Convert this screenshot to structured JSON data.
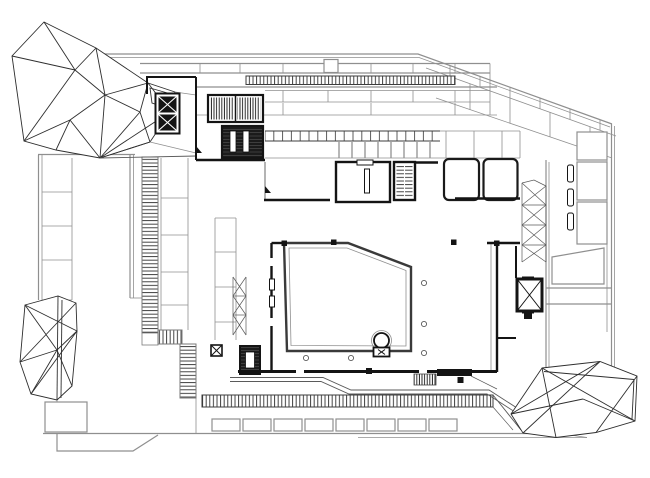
{
  "figure": {
    "kind": "architectural-floor-plan",
    "aria_label": "Black and white architectural floor plan drawing of a museum level with three faceted crystalline volumes, stair and elevator cores, hatched stair strips, colonnade bands and gallery walls"
  },
  "colors": {
    "bg": "#ffffff",
    "env": "#8f8f8f",
    "black": "#141414",
    "dgray": "#3a3a3a",
    "hatch": "#2f2f2f",
    "thin": "#5a5a5a",
    "crystal": "#2e2e2e"
  },
  "elements": {
    "top_left_crystal": "faceted crystal volume",
    "bottom_left_crystal": "faceted crystal volume",
    "bottom_right_crystal": "faceted crystal volume",
    "stair_cores": "hatched stair and service cores",
    "elevators": "elevator shafts with X glyph",
    "colonnade": "column tick bands",
    "galleries": "thick-walled gallery rooms",
    "promenade": "bottom walkway with hatched strip and panel row",
    "facade": "outer envelope bands and cells"
  }
}
